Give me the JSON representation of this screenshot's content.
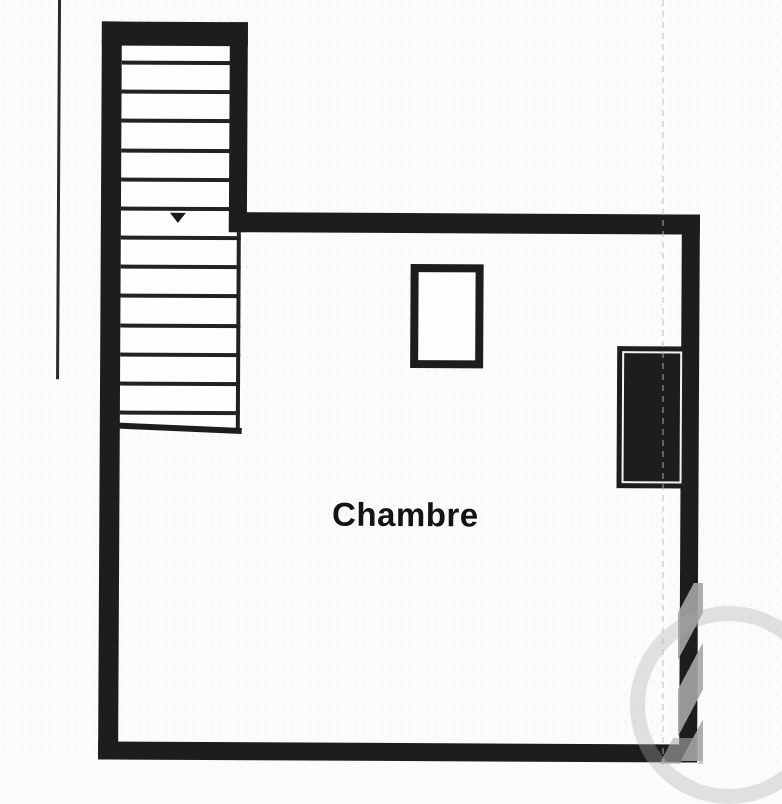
{
  "plan": {
    "room_label": "Chambre",
    "stairs": {
      "tread_count": 13,
      "arrow_direction": "down"
    },
    "colors": {
      "wall": "#1d1d1d",
      "background": "#fbfbf9",
      "watermark_gray": "#b0b0b0"
    }
  }
}
